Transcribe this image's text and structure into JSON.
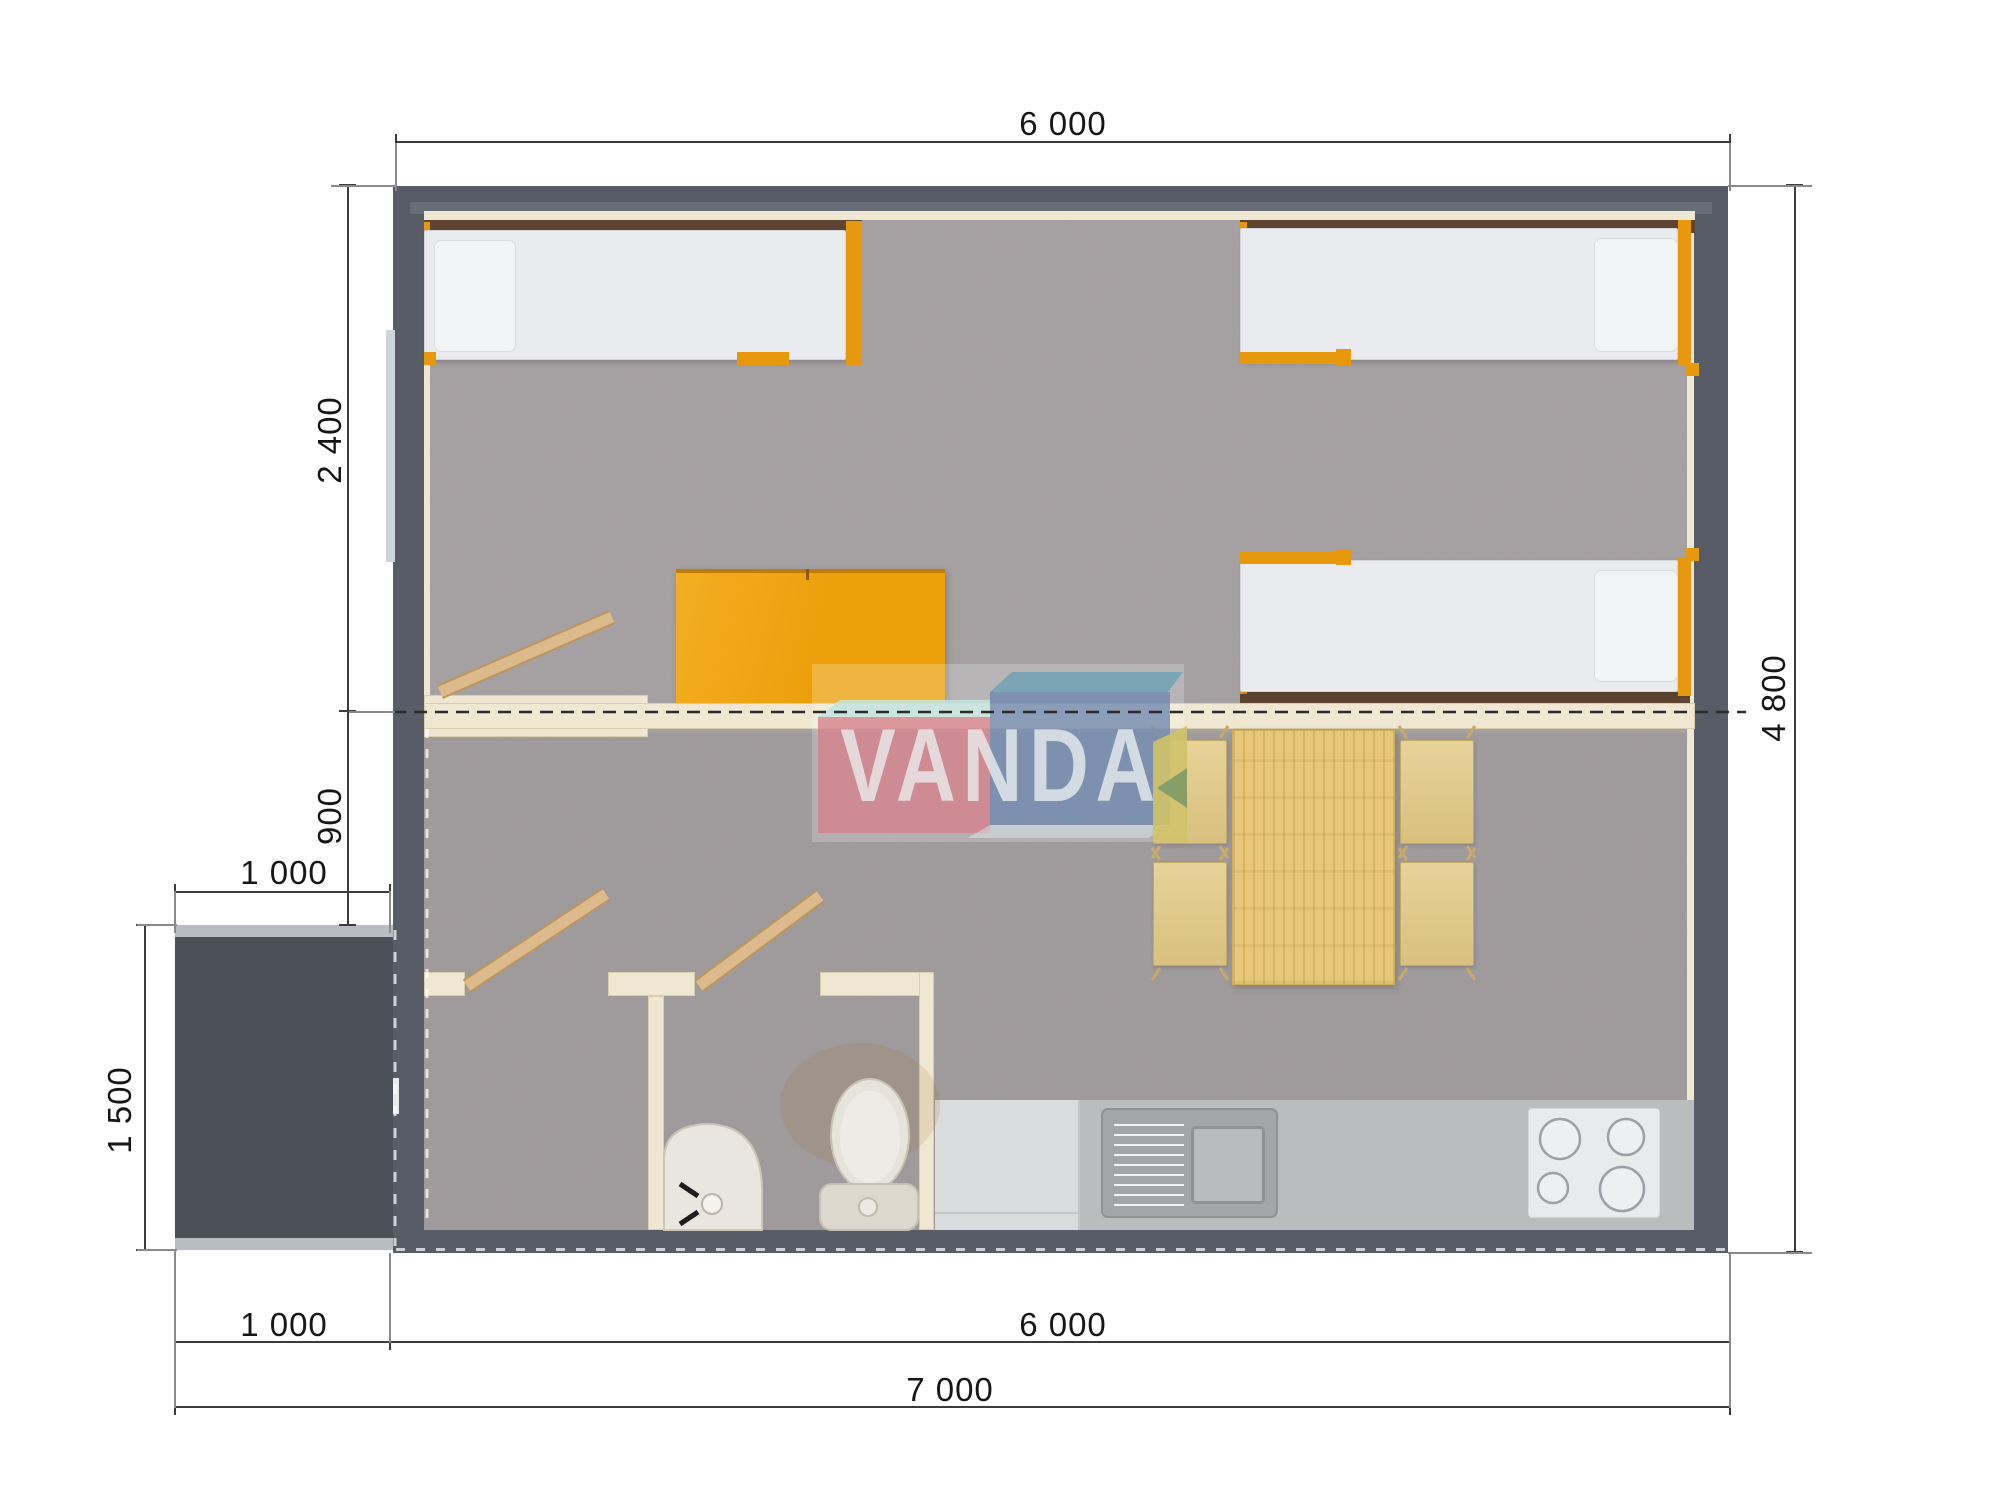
{
  "brand": {
    "watermark": "VANDA"
  },
  "dimensions": {
    "top_width": "6 000",
    "bedroom_depth": "2 400",
    "hallway_depth": "900",
    "porch_width": "1 000",
    "porch_depth": "1 500",
    "house_height": "4 800",
    "bottom_porch_width": "1 000",
    "bottom_house_width": "6 000",
    "total_width": "7 000"
  },
  "colors": {
    "wall": "#575c66",
    "floor_carpet": "#a7a2a4",
    "accent_orange": "#e8980c",
    "interior_wall_cream": "#efe7d1",
    "wood": "#e7c87a",
    "kitchen_counter": "#babcbe",
    "logo_pink": "#d6828d",
    "logo_blue": "#6e86ae",
    "logo_teal": "#6ca0b4",
    "logo_green_fold": "#cfc268"
  },
  "plan_elements": [
    "single-bed-left",
    "single-bed-top-right",
    "single-bed-right",
    "wardrobe",
    "bedroom-door",
    "partition-wall",
    "section-cut-line",
    "shower-room",
    "wc-room",
    "toilet",
    "wash-basin",
    "bathroom-doors",
    "dining-table",
    "dining-chairs",
    "kitchen-counter",
    "kitchen-sink",
    "cooktop-4-burners",
    "porch",
    "entrance-door",
    "window-left-wall"
  ]
}
